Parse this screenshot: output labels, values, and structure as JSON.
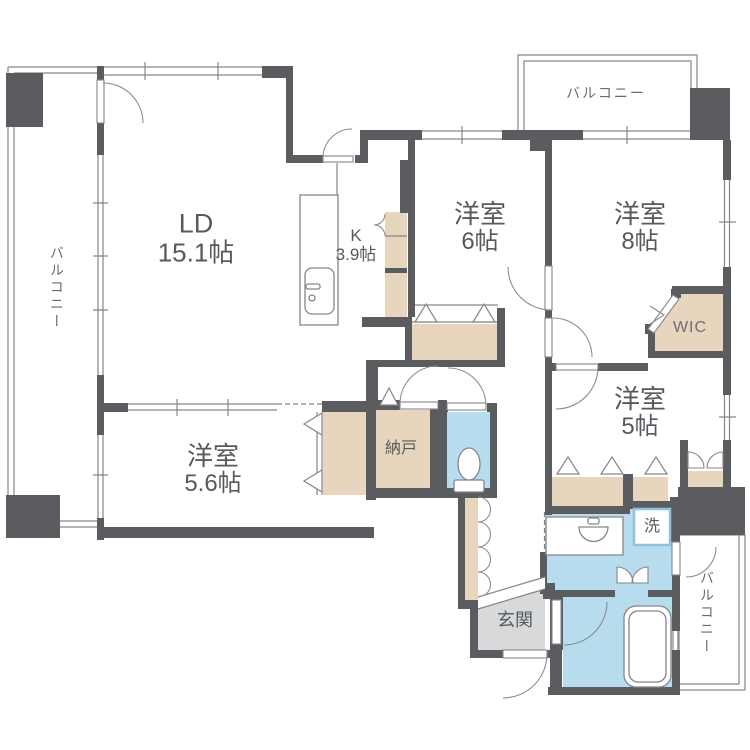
{
  "palette": {
    "wall": "#5b5c5f",
    "closet_fill": "#e8d5bd",
    "water_fill": "#b7dcee",
    "entrance_floor": "#d8d9da",
    "outline_line": "#85868a",
    "text": "#565a5e",
    "washer_box_border": "#8fc3dd"
  },
  "rooms": {
    "ld": {
      "name": "LD",
      "size": "15.1帖"
    },
    "kitchen": {
      "name": "K",
      "size": "3.9帖"
    },
    "bedroom6": {
      "name": "洋室",
      "size": "6帖"
    },
    "bedroom8": {
      "name": "洋室",
      "size": "8帖"
    },
    "bedroom5": {
      "name": "洋室",
      "size": "5帖"
    },
    "bedroom56": {
      "name": "洋室",
      "size": "5.6帖"
    },
    "wic": {
      "label": "WIC"
    },
    "storage": {
      "label": "納戸"
    },
    "entrance": {
      "label": "玄関"
    },
    "laundry": {
      "label": "洗"
    }
  },
  "balconies": {
    "top": {
      "label": "バルコニー"
    },
    "left": {
      "label": "バルコニー"
    },
    "right": {
      "label": "バルコニー"
    }
  }
}
